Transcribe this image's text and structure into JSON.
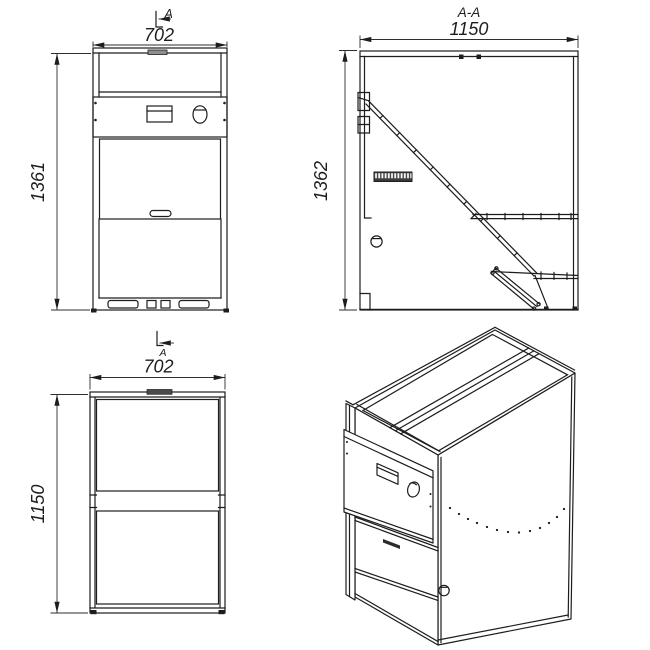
{
  "views": {
    "front": {
      "section_marker": "A",
      "dim_width": "702",
      "dim_height": "1361"
    },
    "section": {
      "title": "A-A",
      "dim_width": "1150",
      "dim_height": "1362"
    },
    "top": {
      "section_marker": "A",
      "dim_width": "702",
      "dim_height": "1150"
    }
  },
  "colors": {
    "line": "#1d1d1d",
    "background": "#ffffff",
    "tab_gray": "#8f8f8f"
  }
}
